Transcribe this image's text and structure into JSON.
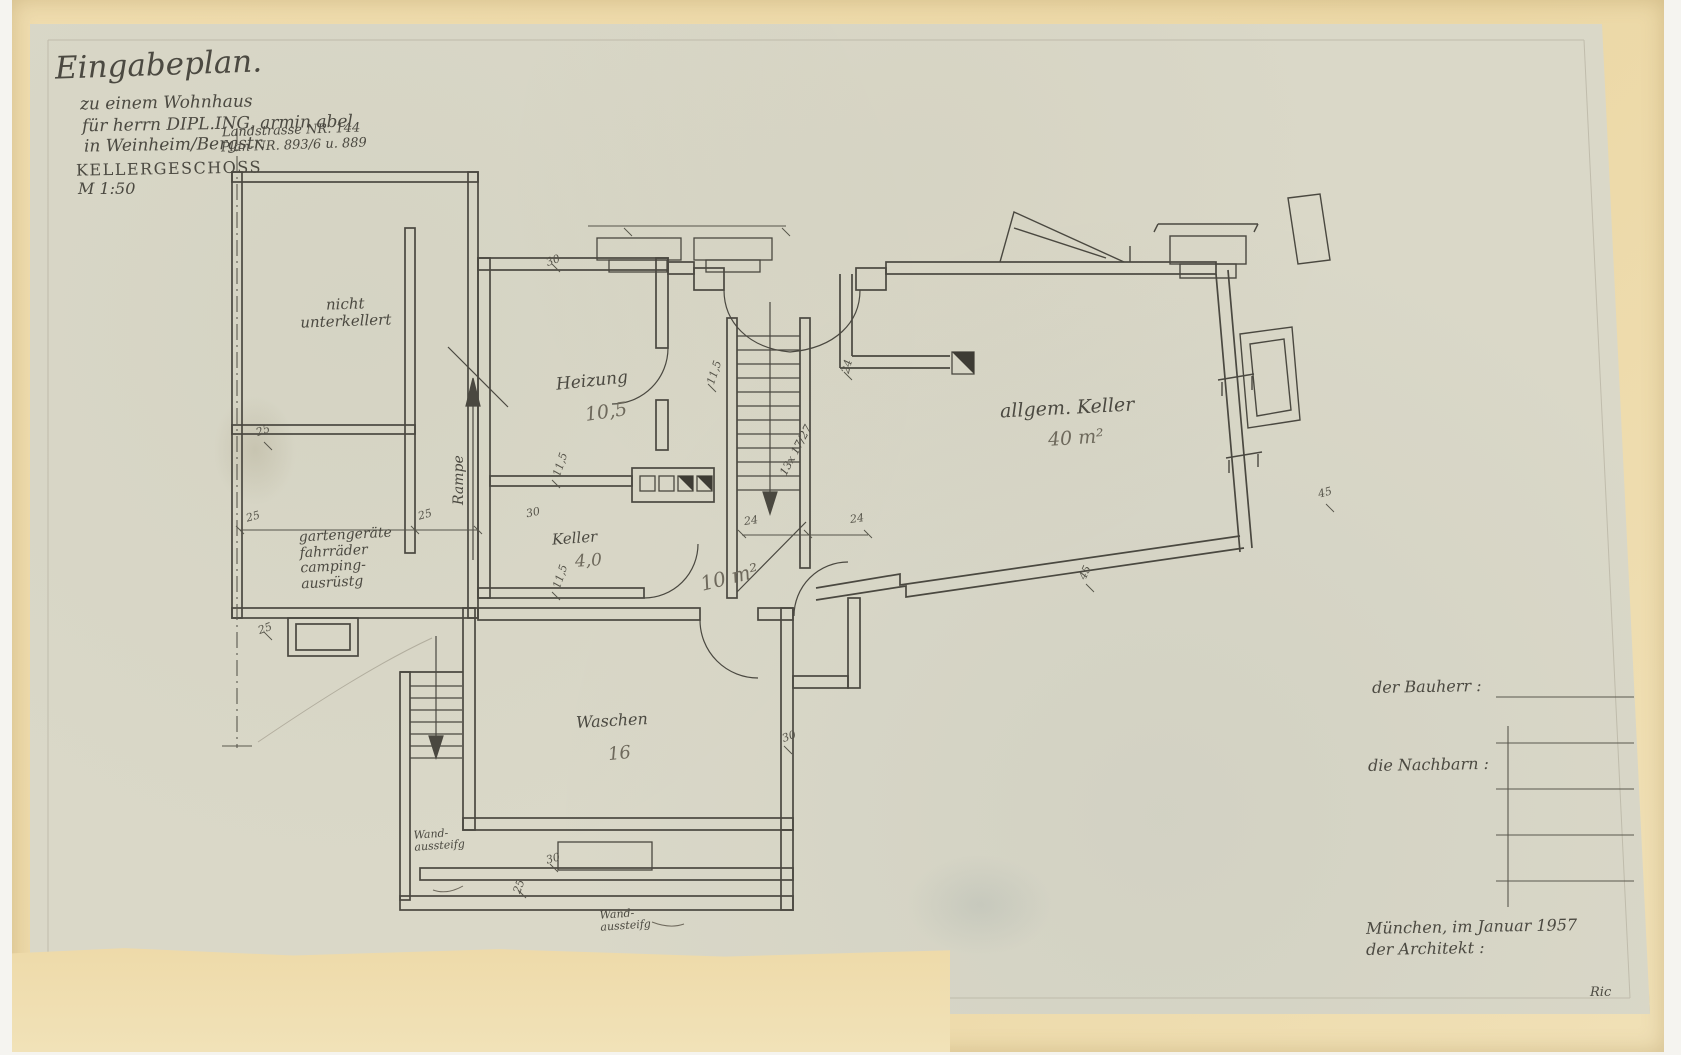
{
  "sheet": {
    "title": "Eingabeplan.",
    "subtitle_line1": "zu einem Wohnhaus",
    "subtitle_line2": "für herrn DIPL.ING. armin abel",
    "subtitle_line3": "in Weinheim/Bergstr.",
    "street_line1": "Landstrasse NR. 144",
    "street_line2": "Plan-NR. 893/6 u. 889",
    "drawing_name": "KELLERGESCHOSS",
    "scale": "M 1:50",
    "paper_color": "#dad8c8",
    "backing_color": "#eedaa9",
    "ink_color": "#4b4941"
  },
  "rooms": {
    "nicht_unterkellert": {
      "line1": "nicht",
      "line2": "unterkellert"
    },
    "geraete": {
      "line1": "gartengeräte",
      "line2": "fahrräder",
      "line3": "camping-",
      "line4": "ausrüstg"
    },
    "rampe": "Rampe",
    "heizung": {
      "name": "Heizung",
      "area": "10,5"
    },
    "keller_small": {
      "name": "Keller",
      "area": "4,0"
    },
    "corridor_area": "10 m²",
    "allgem_keller": {
      "name": "allgem. Keller",
      "area": "40 m²"
    },
    "waschen": {
      "name": "Waschen",
      "area": "16"
    }
  },
  "annotations": {
    "stair_note": "13x 17/27",
    "wall_note1_line1": "Wand-",
    "wall_note1_line2": "aussteifg",
    "wall_note2_line1": "Wand-",
    "wall_note2_line2": "aussteifg"
  },
  "dims": {
    "a": "25",
    "b": "25",
    "c": "25",
    "d": "25",
    "e": "25",
    "f": "30",
    "g": "30",
    "h": "30",
    "i": "30",
    "j": "24",
    "k": "24",
    "l": "24",
    "m": "45",
    "n": "45",
    "o": "11,5",
    "p": "11,5",
    "q": "11,5"
  },
  "signature": {
    "bauherr_label": "der Bauherr :",
    "nachbarn_label": "die Nachbarn :",
    "date_line": "München, im Januar 1957",
    "architekt_label": "der Architekt :",
    "initials": "Ric"
  }
}
